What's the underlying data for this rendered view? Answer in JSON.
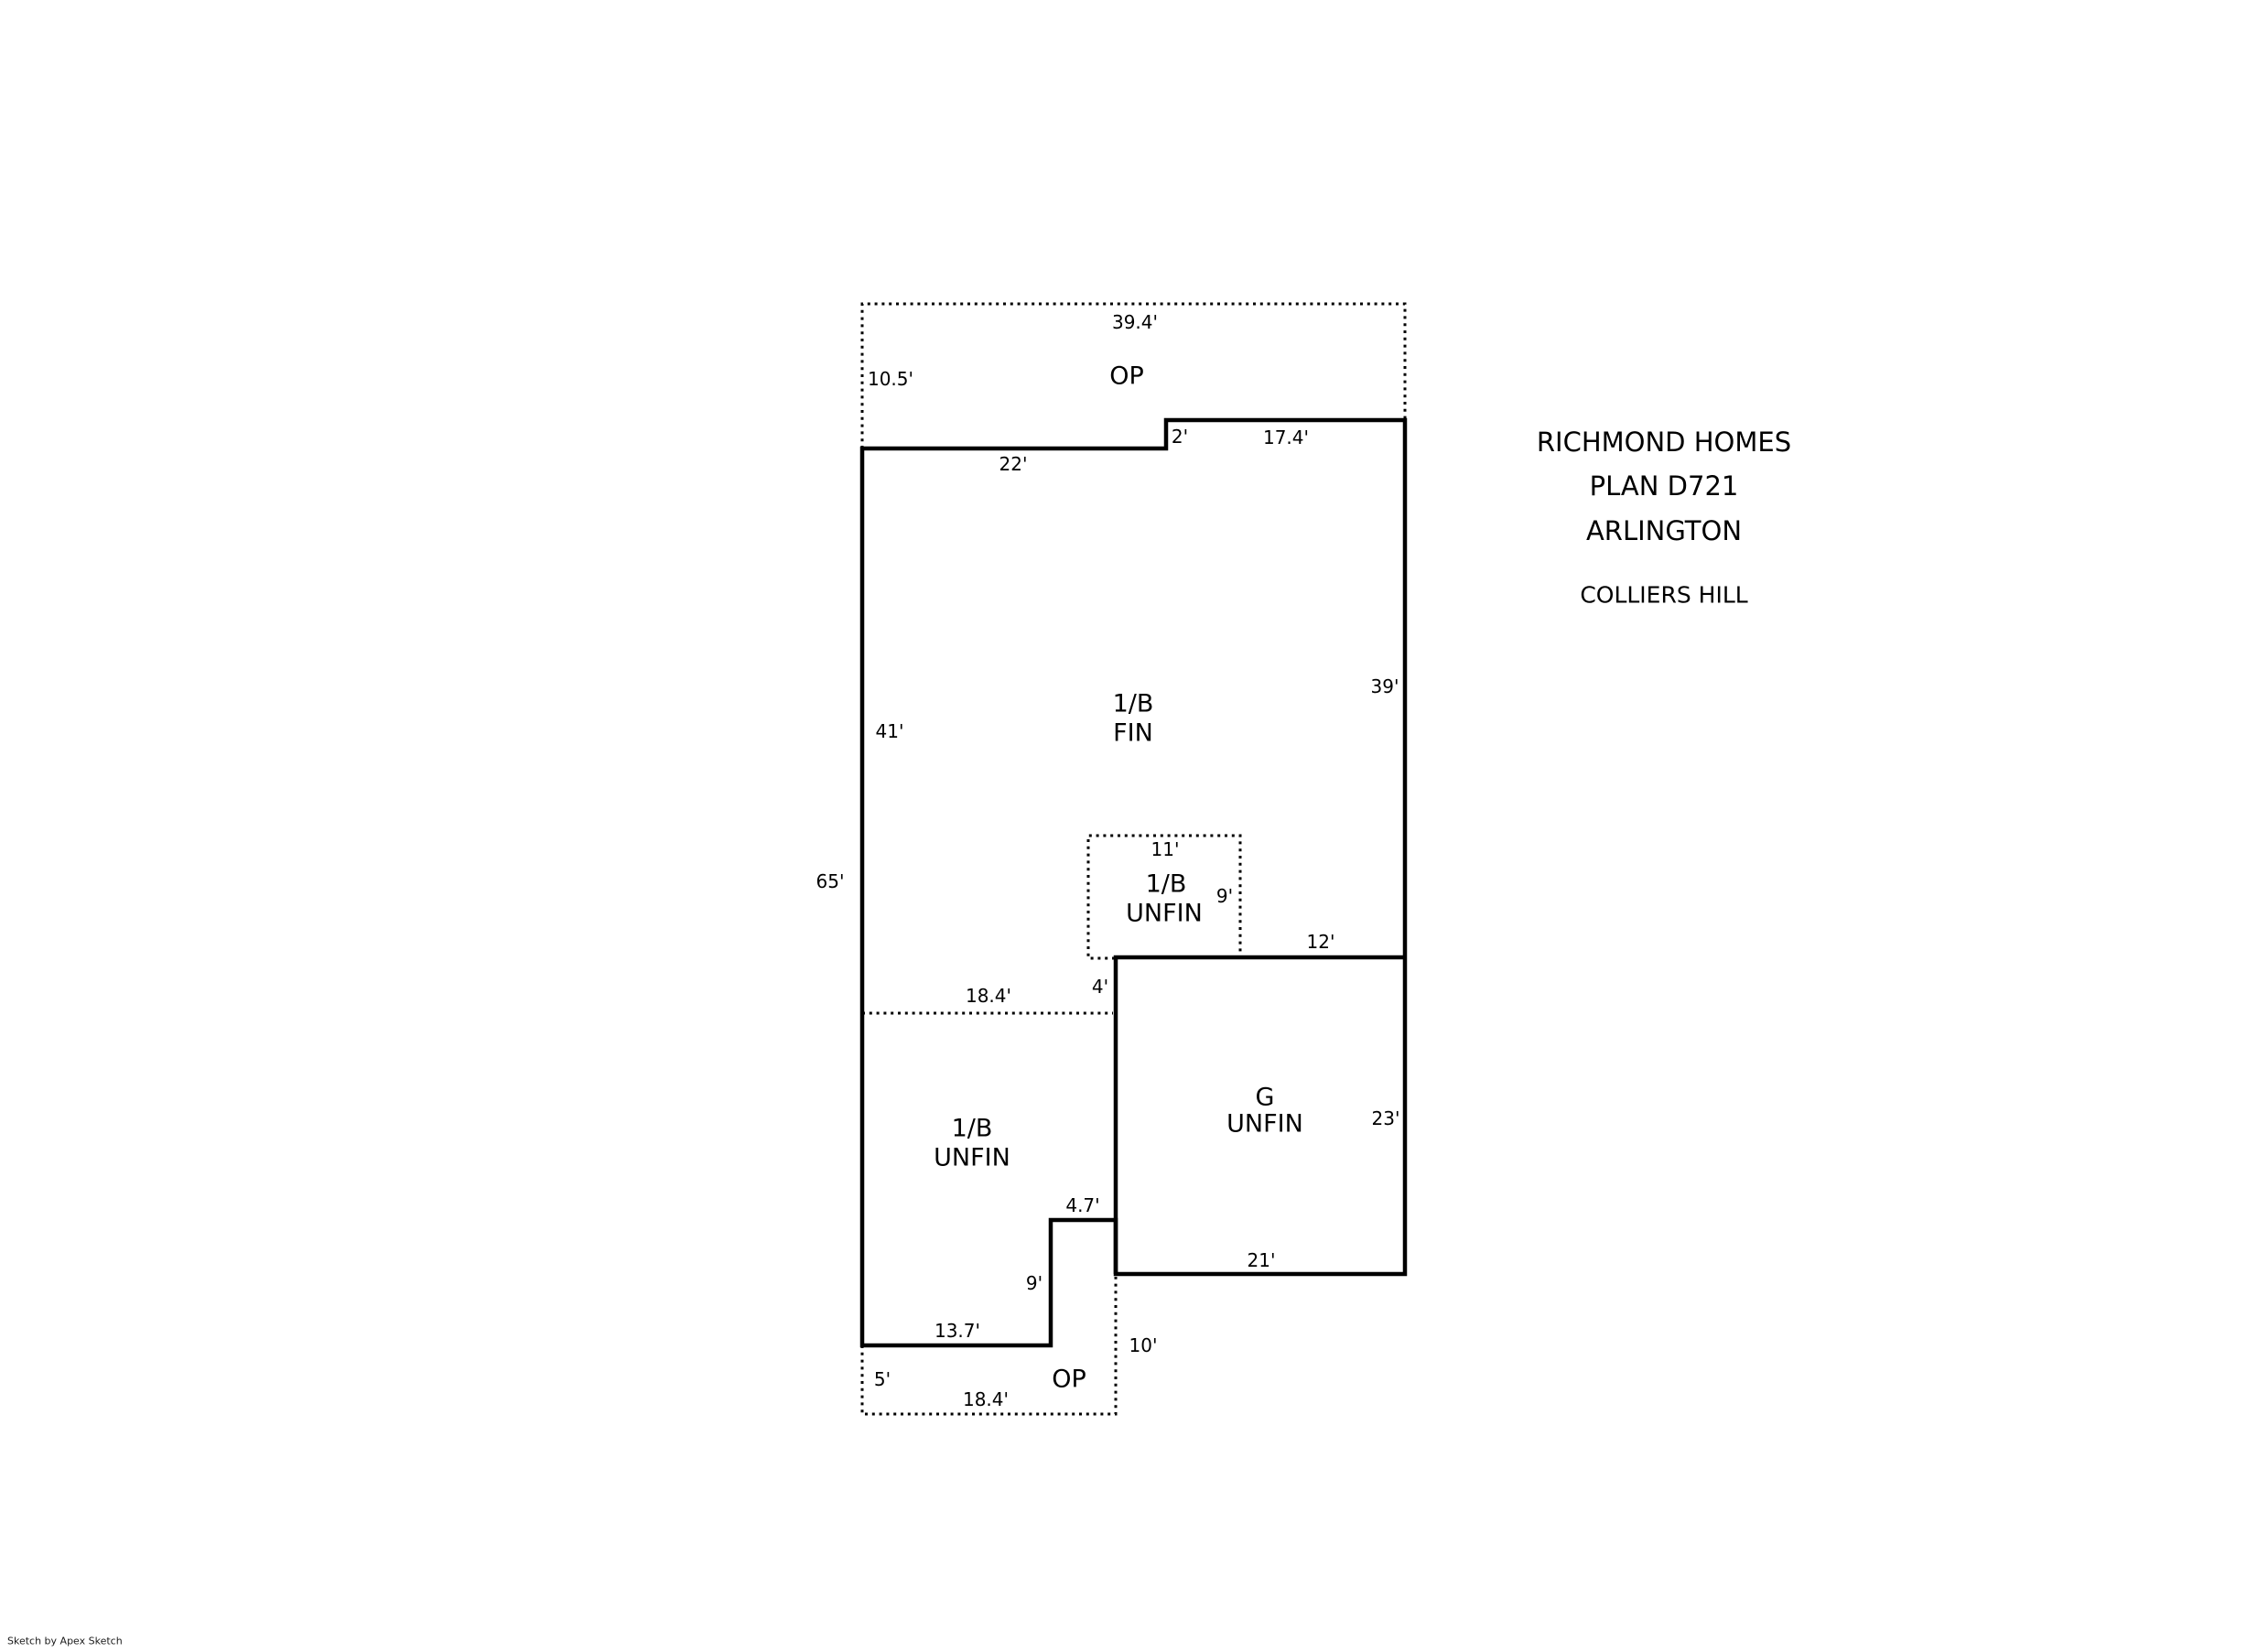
{
  "sketch": {
    "title_block": {
      "line1": "RICHMOND HOMES",
      "line2": "PLAN D721",
      "line3": "ARLINGTON",
      "community": "COLLIERS HILL"
    },
    "credit": "Sketch by Apex Sketch",
    "areas": {
      "porch_top": {
        "label": "OP"
      },
      "basement_finished": {
        "label1": "1/B",
        "label2": "FIN"
      },
      "basement_unfinished_inner": {
        "label1": "1/B",
        "label2": "UNFIN"
      },
      "basement_unfinished_lower": {
        "label1": "1/B",
        "label2": "UNFIN"
      },
      "garage": {
        "label1": "G",
        "label2": "UNFIN"
      },
      "porch_bottom": {
        "label": "OP"
      }
    },
    "dimensions": {
      "porch_top_width": "39.4'",
      "porch_top_height": "10.5'",
      "main_top_left": "22'",
      "main_top_step": "2'",
      "main_top_right": "17.4'",
      "left_wall_upper": "41'",
      "right_wall_upper": "39'",
      "left_wall_total": "65'",
      "inner_box_width": "11'",
      "inner_box_height": "9'",
      "garage_top": "12'",
      "garage_step": "4'",
      "mid_line": "18.4'",
      "notch_width": "4.7'",
      "notch_height": "9'",
      "garage_bottom": "21'",
      "garage_right": "23'",
      "bottom_wall": "13.7'",
      "porch_bottom_left": "5'",
      "porch_bottom_right": "10'",
      "porch_bottom_width": "18.4'"
    }
  }
}
